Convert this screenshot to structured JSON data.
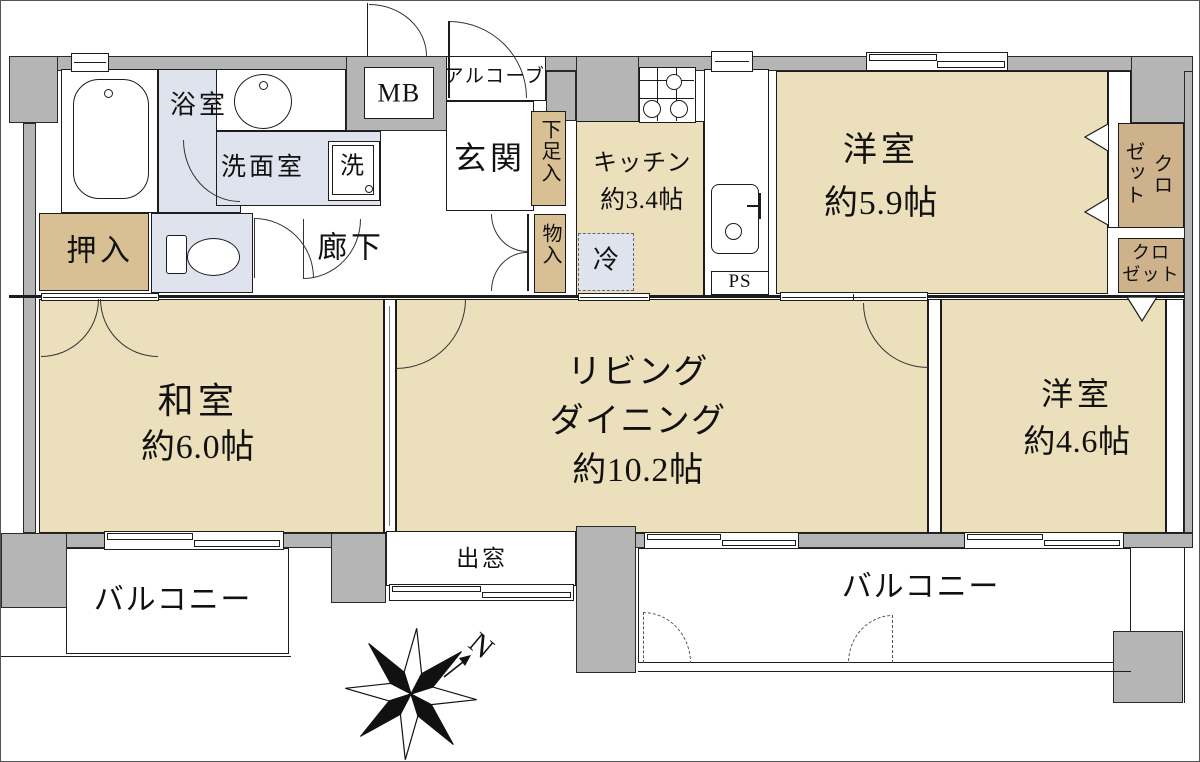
{
  "colors": {
    "room_floor": "#ECE0BC",
    "closet_tan": "#D9C094",
    "closet_dark": "#CDB28C",
    "wet_area_blue": "#DFE3EE",
    "wall_gray": "#B5B5B5",
    "line_black": "#1C1C1C"
  },
  "compass": {
    "north_label": "N"
  },
  "rooms": {
    "bath": {
      "label": "浴室"
    },
    "washroom": {
      "label": "洗面室"
    },
    "washer": {
      "label": "洗"
    },
    "meter_box": {
      "label": "MB"
    },
    "alcove": {
      "label": "アルコーブ"
    },
    "entrance": {
      "label": "玄関"
    },
    "shoe_box": {
      "label": "下足入"
    },
    "hall_storage": {
      "label": "物入"
    },
    "oshiire": {
      "label": "押入"
    },
    "hallway": {
      "label": "廊下"
    },
    "kitchen": {
      "label": "キッチン",
      "size": "約3.4帖"
    },
    "fridge": {
      "label": "冷"
    },
    "pipe_space": {
      "label": "PS"
    },
    "bedroom_59": {
      "label": "洋室",
      "size": "約5.9帖"
    },
    "closet_upper": {
      "line1": "クロ",
      "line2": "ゼット"
    },
    "closet_lower": {
      "line1": "クロ",
      "line2": "ゼット"
    },
    "washitsu": {
      "label": "和室",
      "size": "約6.0帖"
    },
    "living": {
      "line1": "リビング",
      "line2": "ダイニング",
      "size": "約10.2帖"
    },
    "bedroom_46": {
      "label": "洋室",
      "size": "約4.6帖"
    },
    "bay_window": {
      "label": "出窓"
    },
    "balcony_left": {
      "label": "バルコニー"
    },
    "balcony_right": {
      "label": "バルコニー"
    }
  }
}
